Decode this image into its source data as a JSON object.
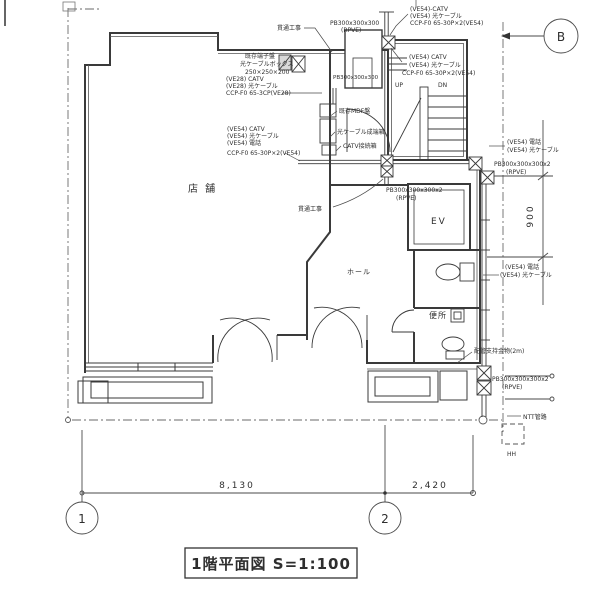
{
  "drawing": {
    "title": "1階平面図  S=1:100",
    "rooms": {
      "store": "店 舗",
      "hall": "ホール",
      "toilet": "便所",
      "elevator": "EV",
      "up": "UP",
      "down": "DN"
    },
    "grid": {
      "b": "B",
      "one": "1",
      "two": "2"
    },
    "dims": {
      "w1": "8,130",
      "w2": "2,420",
      "h1": "900"
    },
    "ann": {
      "pb_top1": "PB300x300x300",
      "pb_top2": "(RPVE)",
      "tr1": "(VE54)-CATV",
      "tr2": "(VE54) 光ケーブル",
      "tr3": "CCP-F0 65-30P×2(VE54)",
      "pen_top": "貫通工事",
      "term1": "既存端子盤",
      "term2": "光ケーブルボックス",
      "term3": "250×250×200",
      "ve28_1": "(VE28) CATV",
      "ve28_2": "(VE28) 光ケーブル",
      "ve28_3": "CCP-F0 65-3CP(VE28)",
      "shaft_pb": "PB300x300x300",
      "stair1": "(VE54) CATV",
      "stair2": "(VE54) 光ケーブル",
      "stair3": "CCP-F0 65-30P×2(VE54)",
      "mdf": "既存MDF盤",
      "fiber_term": "光ケーブル成端箱",
      "catv_box": "CATV接続箱",
      "left1": "(VE54) CATV",
      "left2": "(VE54) 光ケーブル",
      "left3": "(VE54) 電話",
      "left4": "CCP-F0 65-30P×2(VE54)",
      "pen_mid": "貫通工事",
      "pb_mid1": "PB300x300x300x2",
      "pb_mid2": "(RPVE)",
      "ru1": "(VE54) 電話",
      "ru2": "(VE54) 光ケーブル",
      "pb_r1": "PB300x300x300x2",
      "pb_r2": "(RPVE)",
      "rl1": "(VE54) 電話",
      "rl2": "(VE54) 光ケーブル",
      "support": "配管支持金物(2m)",
      "pb_b1": "PB300x300x300x2",
      "pb_b2": "(RPVE)",
      "ntt": "NTT管路",
      "hh": "HH"
    }
  }
}
